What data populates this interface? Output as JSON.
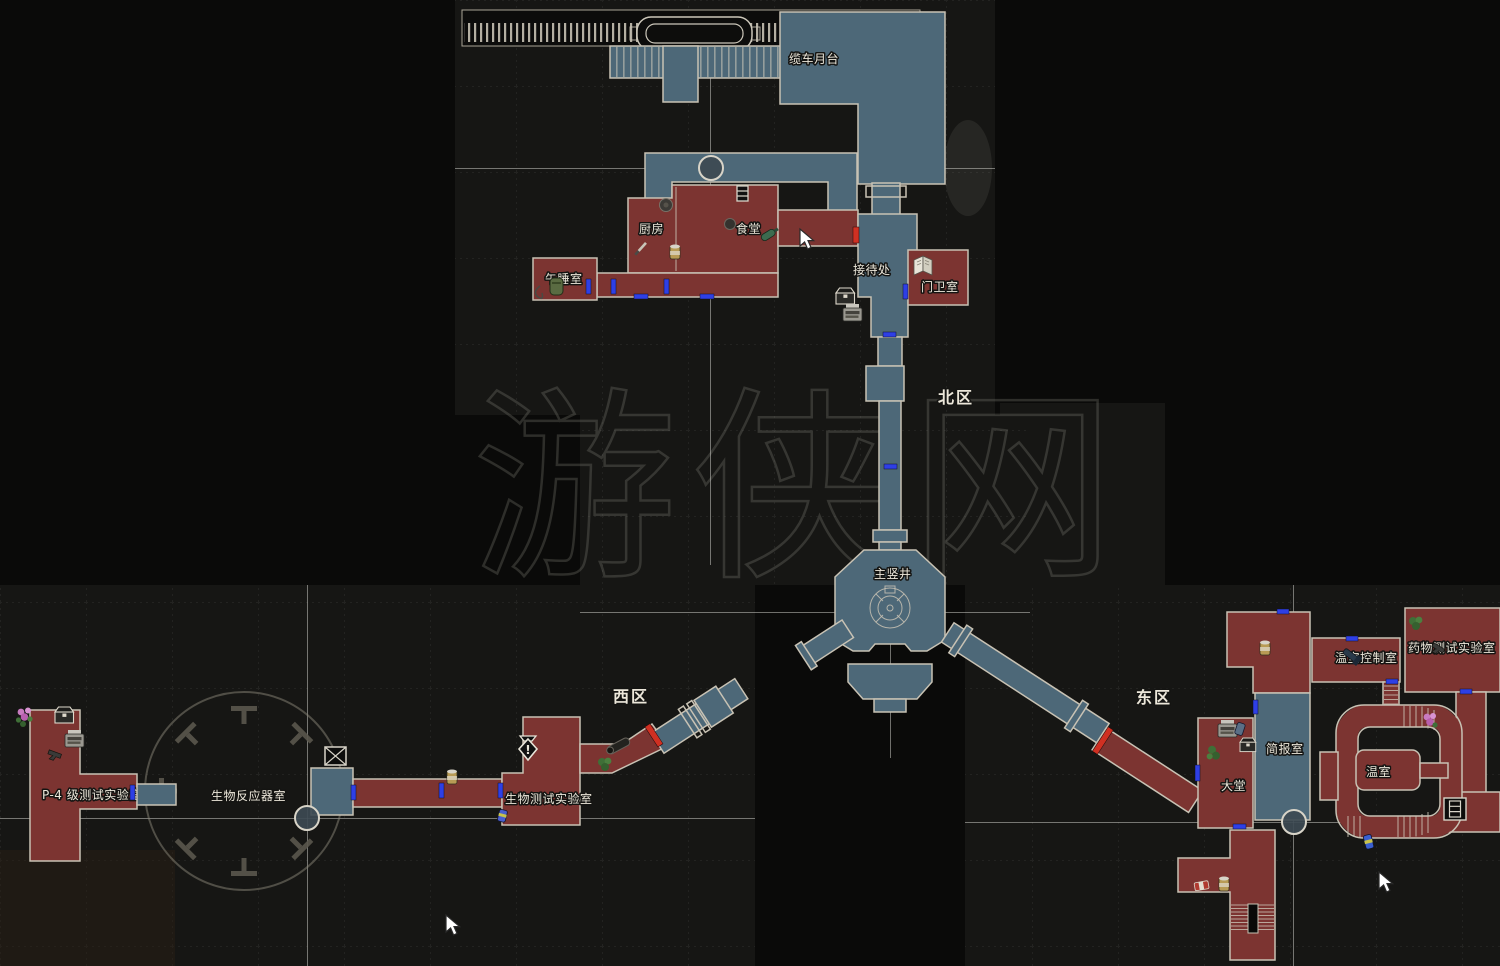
{
  "page": {
    "background": "#0a0a09",
    "watermark": "游侠网"
  },
  "map": {
    "regions": {
      "north": "北区",
      "west": "西区",
      "east": "东区"
    },
    "rooms": {
      "cable_car_platform": "缆车月台",
      "kitchen": "厨房",
      "cafeteria": "食堂",
      "nap_room": "午睡室",
      "reception": "接待处",
      "guard_room": "门卫室",
      "main_shaft": "主竖井",
      "p4_test_lab": "P-4 级测试实验室",
      "bioreactor_room": "生物反应器室",
      "bio_test_lab": "生物测试实验室",
      "lobby": "大堂",
      "briefing_room": "简报室",
      "greenhouse_control_room": "温室控制室",
      "drug_test_lab": "药物测试实验室",
      "greenhouse": "温室"
    },
    "legend_colors": {
      "explored_room": "#7c3431",
      "walkway_area": "#4d6878",
      "wall": "#c8c2b4",
      "door": "#2e3fe6",
      "locked_door": "#d03022",
      "label_text": "#ece7da"
    },
    "icons": {
      "typewriter": "typewriter save point",
      "item_box": "item box",
      "map_book": "open map",
      "herb_green": "green herb",
      "herb_pink": "flowers",
      "handgun": "weapon item",
      "knife": "knife item",
      "can": "canned item",
      "bottle": "bottle item",
      "pot": "pot",
      "exclamation": "key item marker",
      "exclamation_glyph": "!",
      "lift": "lift box",
      "ladder": "ladder",
      "stairs": "stairs",
      "cursor": "mouse cursor"
    }
  }
}
